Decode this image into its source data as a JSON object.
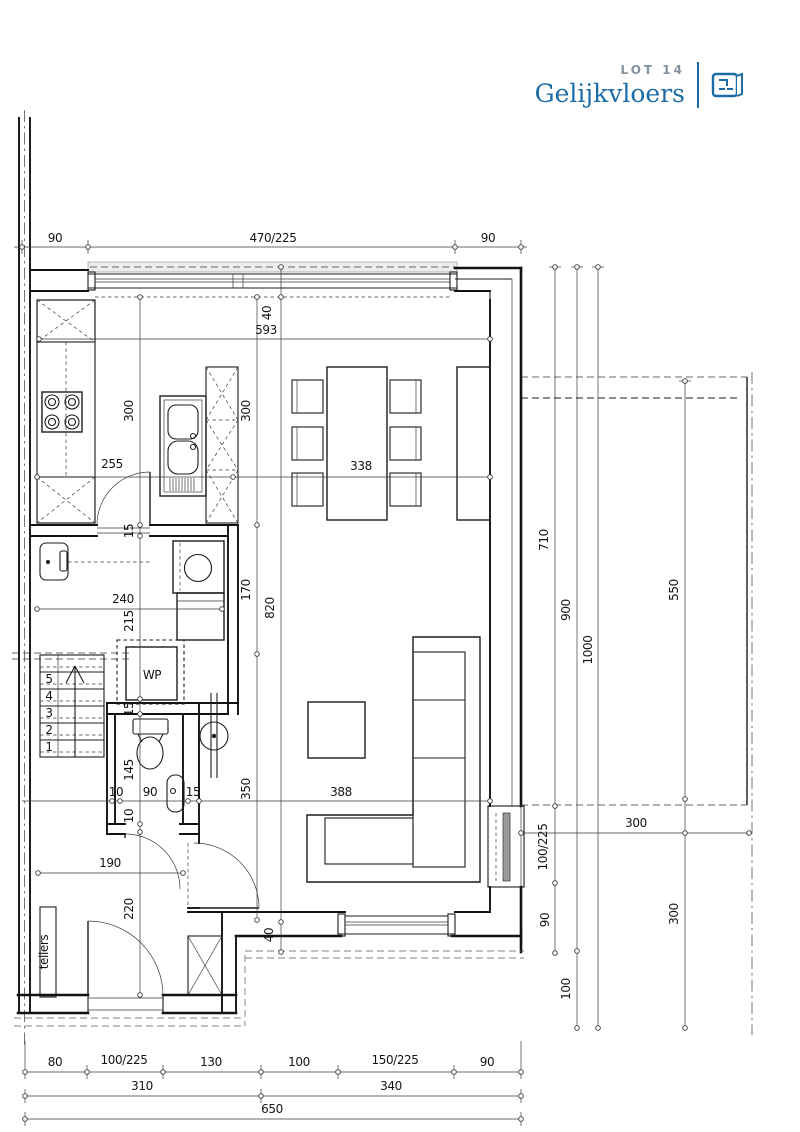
{
  "header": {
    "lot": "LOT 14",
    "title": "Gelijkvloers"
  },
  "colors": {
    "accent": "#1c6ca7",
    "lot_gray": "#84929f",
    "line": "#121212",
    "glazing": "#9b9b9b"
  },
  "plan": {
    "labels": [
      {
        "t": "90",
        "x": 55,
        "y": 242
      },
      {
        "t": "470/225",
        "x": 273,
        "y": 242
      },
      {
        "t": "90",
        "x": 488,
        "y": 242
      },
      {
        "t": "40",
        "x": 271,
        "y": 313,
        "r": 1
      },
      {
        "t": "593",
        "x": 266,
        "y": 334
      },
      {
        "t": "300",
        "x": 133,
        "y": 411,
        "r": 1
      },
      {
        "t": "300",
        "x": 250,
        "y": 411,
        "r": 1
      },
      {
        "t": "255",
        "x": 112,
        "y": 468
      },
      {
        "t": "338",
        "x": 361,
        "y": 470
      },
      {
        "t": "15",
        "x": 133,
        "y": 531,
        "r": 1
      },
      {
        "t": "170",
        "x": 250,
        "y": 590,
        "r": 1
      },
      {
        "t": "820",
        "x": 274,
        "y": 608,
        "r": 1
      },
      {
        "t": "240",
        "x": 123,
        "y": 603
      },
      {
        "t": "215",
        "x": 133,
        "y": 621,
        "r": 1
      },
      {
        "t": "WP",
        "x": 152,
        "y": 679,
        "s": 11,
        "n": "room-label-wp"
      },
      {
        "t": "15",
        "x": 133,
        "y": 709,
        "r": 1
      },
      {
        "t": "145",
        "x": 133,
        "y": 770,
        "r": 1
      },
      {
        "t": "10",
        "x": 133,
        "y": 816,
        "r": 1
      },
      {
        "t": "10",
        "x": 116,
        "y": 796
      },
      {
        "t": "90",
        "x": 150,
        "y": 796
      },
      {
        "t": "15",
        "x": 193,
        "y": 796
      },
      {
        "t": "350",
        "x": 250,
        "y": 789,
        "r": 1
      },
      {
        "t": "388",
        "x": 341,
        "y": 796
      },
      {
        "t": "190",
        "x": 110,
        "y": 867
      },
      {
        "t": "220",
        "x": 133,
        "y": 909,
        "r": 1
      },
      {
        "t": "40",
        "x": 273,
        "y": 935,
        "r": 1
      },
      {
        "t": "tellers",
        "x": 48,
        "y": 952,
        "r": 1,
        "s": 10,
        "n": "room-label-tellers"
      },
      {
        "t": "1",
        "x": 49,
        "y": 751,
        "s": 7,
        "n": "stair-number"
      },
      {
        "t": "2",
        "x": 49,
        "y": 734,
        "s": 7,
        "n": "stair-number"
      },
      {
        "t": "3",
        "x": 49,
        "y": 717,
        "s": 7,
        "n": "stair-number"
      },
      {
        "t": "4",
        "x": 49,
        "y": 700,
        "s": 7,
        "n": "stair-number"
      },
      {
        "t": "5",
        "x": 49,
        "y": 683,
        "s": 7,
        "n": "stair-number"
      },
      {
        "t": "710",
        "x": 548,
        "y": 540,
        "r": 1
      },
      {
        "t": "900",
        "x": 570,
        "y": 610,
        "r": 1
      },
      {
        "t": "1000",
        "x": 592,
        "y": 650,
        "r": 1
      },
      {
        "t": "550",
        "x": 678,
        "y": 590,
        "r": 1
      },
      {
        "t": "300",
        "x": 636,
        "y": 827
      },
      {
        "t": "100/225",
        "x": 547,
        "y": 847,
        "r": 1
      },
      {
        "t": "90",
        "x": 549,
        "y": 920,
        "r": 1
      },
      {
        "t": "100",
        "x": 570,
        "y": 989,
        "r": 1
      },
      {
        "t": "300",
        "x": 678,
        "y": 914,
        "r": 1
      },
      {
        "t": "80",
        "x": 55,
        "y": 1066
      },
      {
        "t": "100/225",
        "x": 124,
        "y": 1064
      },
      {
        "t": "130",
        "x": 211,
        "y": 1066
      },
      {
        "t": "100",
        "x": 299,
        "y": 1066
      },
      {
        "t": "150/225",
        "x": 395,
        "y": 1064
      },
      {
        "t": "90",
        "x": 487,
        "y": 1066
      },
      {
        "t": "310",
        "x": 142,
        "y": 1090
      },
      {
        "t": "340",
        "x": 391,
        "y": 1090
      },
      {
        "t": "650",
        "x": 272,
        "y": 1113
      }
    ]
  }
}
